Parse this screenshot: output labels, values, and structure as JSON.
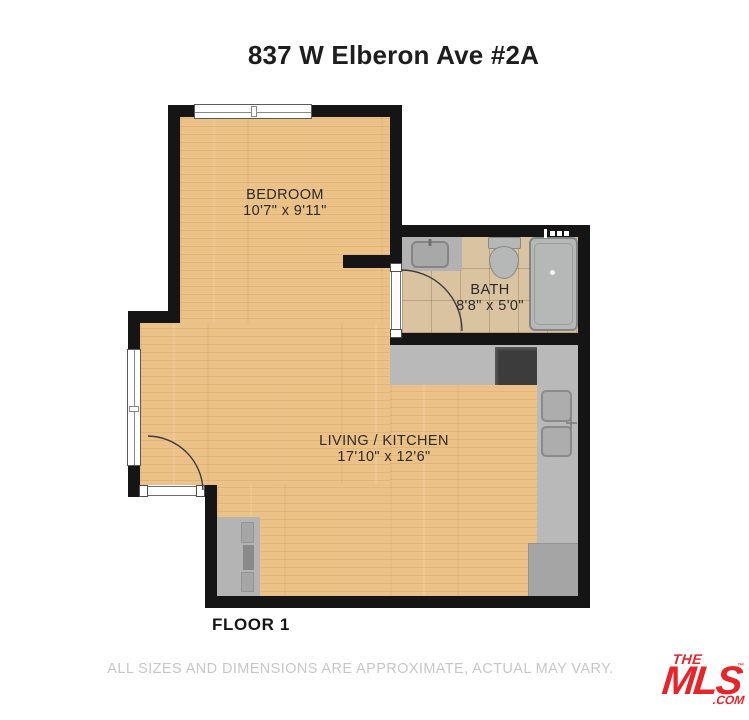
{
  "title": "837 W Elberon Ave #2A",
  "floor_label": "FLOOR 1",
  "disclaimer": "ALL SIZES AND DIMENSIONS ARE APPROXIMATE, ACTUAL MAY VARY.",
  "rooms": {
    "bedroom": {
      "name": "BEDROOM",
      "dims": "10'7\" x 9'11\""
    },
    "bath": {
      "name": "BATH",
      "dims": "8'8\" x 5'0\""
    },
    "living_kitchen": {
      "name": "LIVING / KITCHEN",
      "dims": "17'10\" x 12'6\""
    }
  },
  "logo": {
    "the": "THE",
    "mls": "MLS",
    "tm": "™",
    "com": ".COM"
  },
  "colors": {
    "wall": "#151515",
    "wood": "#edc287",
    "tile": "#d9c3a1",
    "counter": "#b9b9b9",
    "fixture": "#b5b8b6",
    "accent": "#e8242b",
    "label": "#2b2b2b",
    "muted": "#c7c7c7"
  }
}
